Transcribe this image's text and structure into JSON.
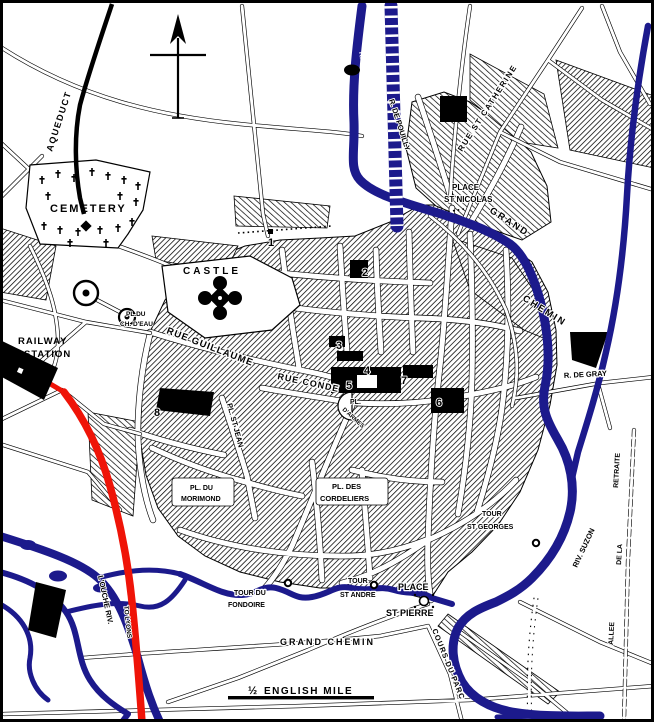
{
  "palette": {
    "ink": "#000000",
    "paper": "#ffffff",
    "river_blue": "#1c1a8c",
    "road_red": "#ef1408"
  },
  "labels": {
    "aqueduct": "AQUEDUCT",
    "cemetery": "CEMETERY",
    "castle": "CASTLE",
    "railway_1": "RAILWAY",
    "railway_2": "STATION",
    "pl_chateau_eau_1": "PL.DU",
    "pl_chateau_eau_2": "CH. D'EAU",
    "rue_guillaume": "RUE GUILLAUME",
    "rue_conde": "RUE CONDE",
    "pl_st_jean": "PL. ST JEAN",
    "pl_armes_1": "PL.",
    "pl_armes_2": "D'ARMES",
    "r_suzon_top": "R. SUZON",
    "r_de_pouilly": "R. DE POUILLY",
    "place_st_nicolas_1": "PLACE",
    "place_st_nicolas_2": "ST NICOLAS",
    "rue_st_catherine": "RUE ST CATHERINE",
    "grand_top": "GRAND",
    "chemin_top": "CHEMIN",
    "r_de_gray": "R. DE GRAY",
    "riv_suzon": "RIV. SUZON",
    "allee": "ALLEE",
    "de_la": "DE LA",
    "retraite": "RETRAITE",
    "pl_morimond_1": "PL. DU",
    "pl_morimond_2": "MORIMOND",
    "pl_cordeliers_1": "PL. DES",
    "pl_cordeliers_2": "CORDELIERS",
    "tour_st_georges_1": "TOUR",
    "tour_st_georges_2": "ST GEORGES",
    "tour_st_andre_1": "TOUR",
    "tour_st_andre_2": "ST ANDRE",
    "tour_fondoire_1": "TOUR DU",
    "tour_fondoire_2": "FONDOIRE",
    "place_st_pierre_1": "PLACE",
    "place_st_pierre_2": "ST PIERRE",
    "grand_chemin_bottom": "GRAND CHEMIN",
    "cours_du_parc": "COURS DU PARC",
    "l_ouche_riv": "L'OUCHE RIV.",
    "to_lyons": "TO LYONS",
    "scale_fraction": "½",
    "scale_label": "ENGLISH MILE"
  },
  "markers": {
    "m1": "1",
    "m2": "2",
    "m3": "3",
    "m4": "4",
    "m5": "5",
    "m6": "6",
    "m7": "7",
    "m8": "8"
  }
}
